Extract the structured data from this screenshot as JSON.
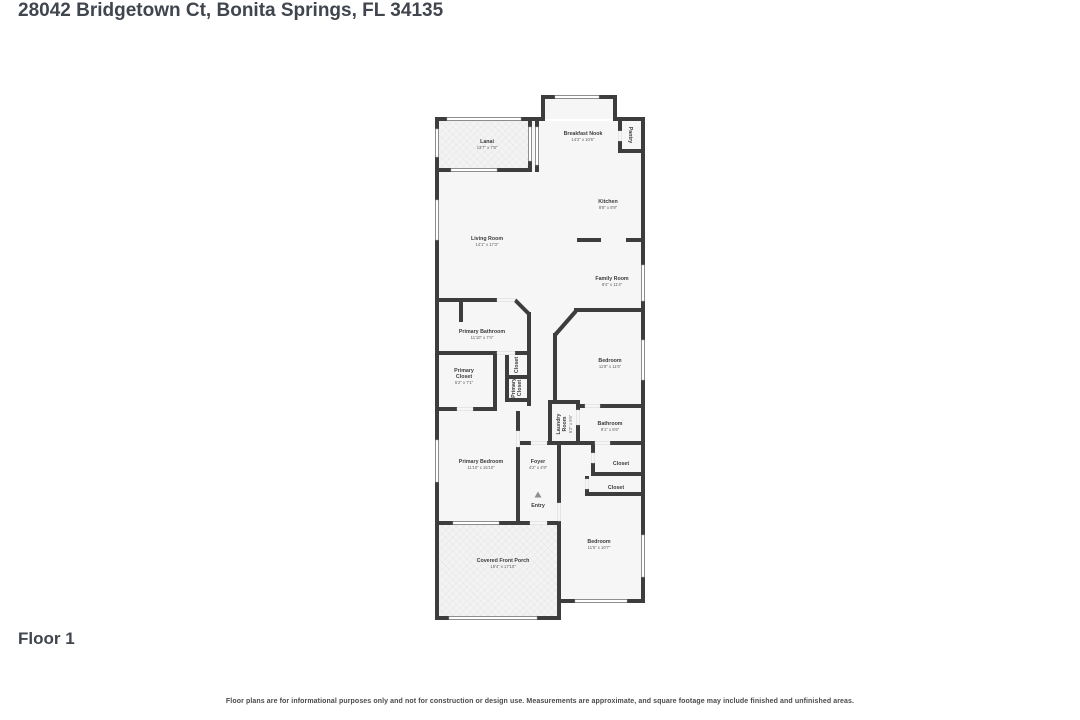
{
  "page": {
    "title": "28042 Bridgetown Ct, Bonita Springs, FL 34135",
    "floor_label": "Floor 1",
    "disclaimer": "Floor plans are for informational purposes only and not for construction or design use. Measurements are approximate, and square footage may include finished and unfinished areas."
  },
  "floor_plan": {
    "wall_color": "#3d3d3d",
    "floor_color": "#f6f6f6",
    "hatch_color": "#e2e2e2",
    "rooms": [
      {
        "lines": [
          "Lanai"
        ],
        "dims": "13'7\" x 7'8\"",
        "x": 52,
        "y": 49,
        "rot": 0
      },
      {
        "lines": [
          "Breakfast Nook"
        ],
        "dims": "14'2\" x 10'6\"",
        "x": 148,
        "y": 41,
        "rot": 0
      },
      {
        "lines": [
          "Pantry"
        ],
        "dims": "",
        "x": 196,
        "y": 40,
        "rot": 90
      },
      {
        "lines": [
          "Kitchen"
        ],
        "dims": "8'8\" x 8'9\"",
        "x": 173,
        "y": 109,
        "rot": 0
      },
      {
        "lines": [
          "Living Room"
        ],
        "dims": "14'1\" x 17'3\"",
        "x": 52,
        "y": 146,
        "rot": 0
      },
      {
        "lines": [
          "Family Room"
        ],
        "dims": "8'4\" x 11'4\"",
        "x": 177,
        "y": 186,
        "rot": 0
      },
      {
        "lines": [
          "Primary Bathroom"
        ],
        "dims": "11'10\" x 7'4\"",
        "x": 47,
        "y": 239,
        "rot": 0
      },
      {
        "lines": [
          "Primary",
          "Closet"
        ],
        "dims": "5'2\" x 7'1\"",
        "x": 29,
        "y": 281,
        "rot": 0
      },
      {
        "lines": [
          "Closet"
        ],
        "dims": "",
        "x": 81,
        "y": 270,
        "rot": -90
      },
      {
        "lines": [
          "Primary",
          "Closet"
        ],
        "dims": "",
        "x": 81,
        "y": 293,
        "rot": -90
      },
      {
        "lines": [
          "Bedroom"
        ],
        "dims": "11'8\" x 11'6\"",
        "x": 175,
        "y": 268,
        "rot": 0
      },
      {
        "lines": [
          "Laundry",
          "Room"
        ],
        "dims": "5'2\" x 5'6\"",
        "x": 129,
        "y": 329,
        "rot": -90
      },
      {
        "lines": [
          "Bathroom"
        ],
        "dims": "8'1\" x 5'6\"",
        "x": 175,
        "y": 331,
        "rot": 0
      },
      {
        "lines": [
          "Foyer"
        ],
        "dims": "4'2\" x 4'9\"",
        "x": 103,
        "y": 369,
        "rot": 0
      },
      {
        "lines": [
          "Closet"
        ],
        "dims": "",
        "x": 186,
        "y": 368,
        "rot": 0
      },
      {
        "lines": [
          "Closet"
        ],
        "dims": "",
        "x": 181,
        "y": 392,
        "rot": 0
      },
      {
        "lines": [
          "Entry"
        ],
        "dims": "",
        "x": 103,
        "y": 410,
        "rot": 0
      },
      {
        "lines": [
          "Primary Bedroom"
        ],
        "dims": "11'10\" x 15'10\"",
        "x": 46,
        "y": 369,
        "rot": 0
      },
      {
        "lines": [
          "Bedroom"
        ],
        "dims": "11'5\" x 10'7\"",
        "x": 164,
        "y": 449,
        "rot": 0
      },
      {
        "lines": [
          "Covered Front Porch"
        ],
        "dims": "16'4\" x 17'10\"",
        "x": 68,
        "y": 468,
        "rot": 0
      }
    ]
  }
}
